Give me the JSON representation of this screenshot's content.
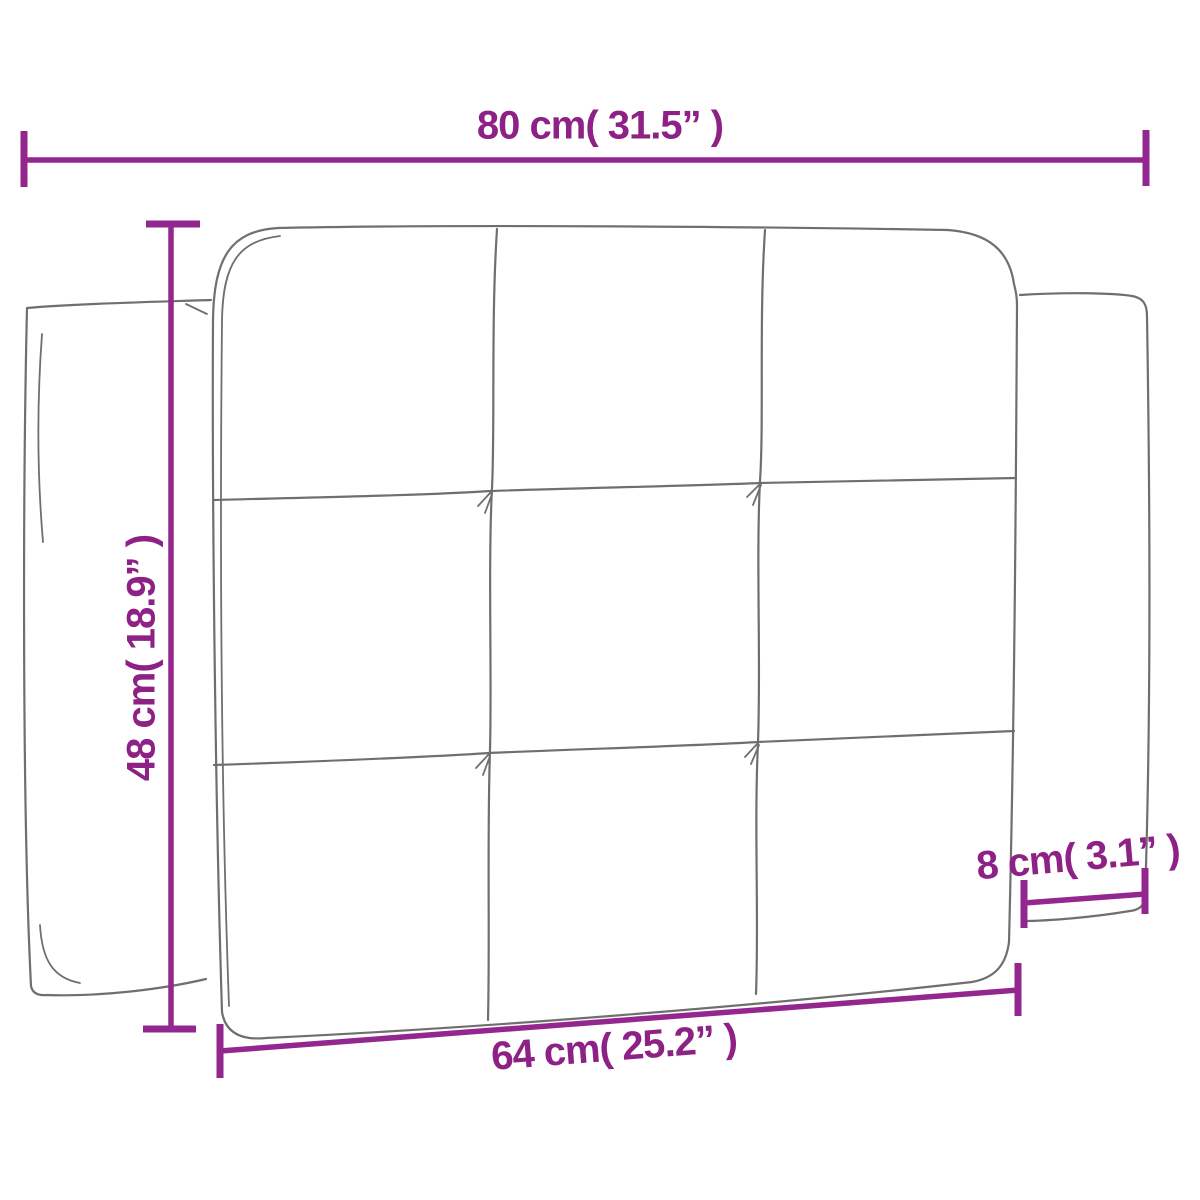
{
  "diagram": {
    "type": "product-dimension-diagram",
    "subject": "tufted-headboard-cushion-3x3",
    "colors": {
      "dimension_lines": "#93278F",
      "label_text": "#8E2185",
      "outline": "#6f6f6f",
      "background": "#ffffff"
    },
    "dimensions": {
      "top_width": {
        "label": "80 cm( 31.5” )",
        "cm": 80,
        "inches": 31.5
      },
      "left_height": {
        "label": "48 cm( 18.9” )",
        "cm": 48,
        "inches": 18.9
      },
      "bottom_width": {
        "label": "64 cm( 25.2” )",
        "cm": 64,
        "inches": 25.2
      },
      "right_depth": {
        "label": "8 cm( 3.1” )",
        "cm": 8,
        "inches": 3.1
      }
    }
  }
}
